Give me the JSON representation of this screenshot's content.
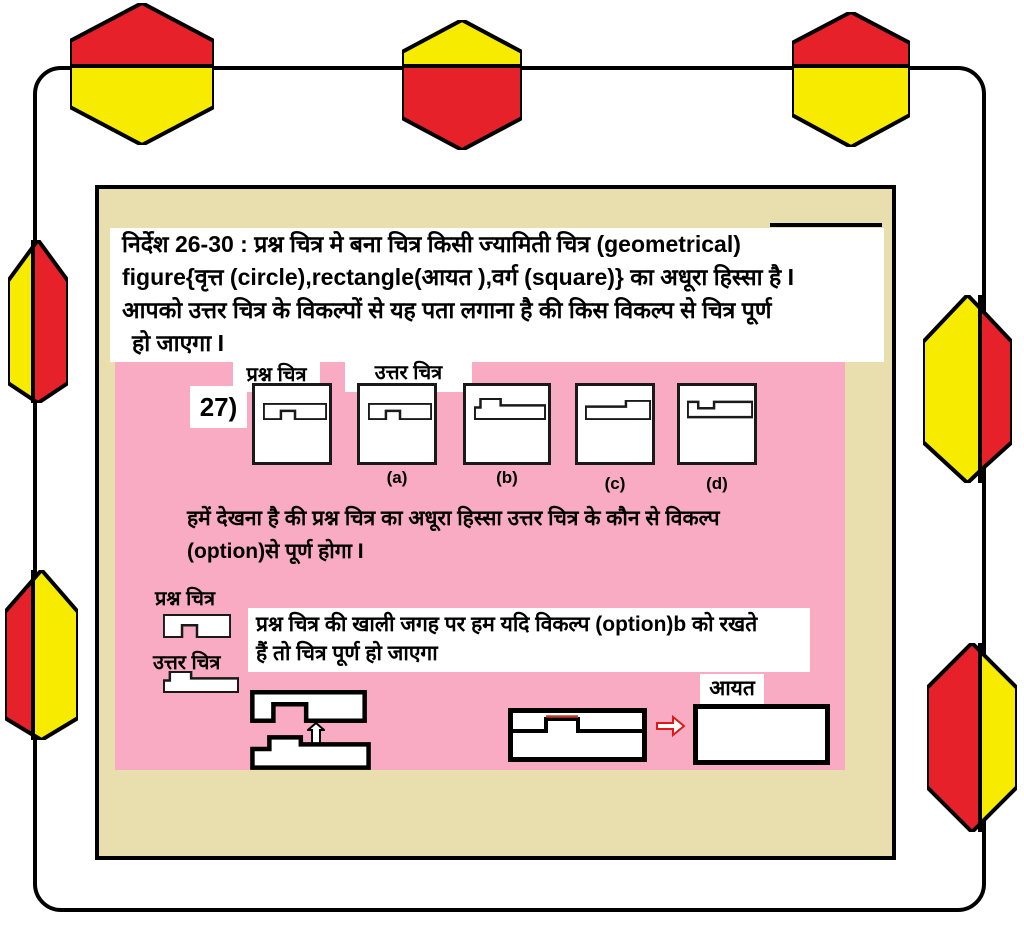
{
  "colors": {
    "page_background": "#ffffff",
    "panel_tan": "#e9dfae",
    "panel_pink": "#f8abc3",
    "decor_red": "#e62129",
    "decor_yellow": "#f7ec00",
    "border_black": "#000000",
    "seam_red": "#c0392b"
  },
  "instructions": {
    "line1": "निर्देश 26-30 : प्रश्न चित्र मे बना चित्र किसी ज्यामिती चित्र (geometrical)",
    "line2": "figure{वृत्त (circle),rectangle(आयत ),वर्ग (square)} का अधूरा हिस्सा है I",
    "line3": "आपको उत्तर चित्र के विकल्पों से यह पता लगाना है की किस विकल्प से चित्र पूर्ण",
    "line4": "हो जाएगा I"
  },
  "question": {
    "number_label": "27)",
    "question_figure_label": "प्रश्न चित्र",
    "answer_figure_label": "उत्तर  चित्र",
    "options": [
      {
        "label": "(a)"
      },
      {
        "label": "(b)"
      },
      {
        "label": "(c)"
      },
      {
        "label": "(d)"
      }
    ]
  },
  "explanation": {
    "observe_line1": "हमें देखना है की प्रश्न चित्र का अधूरा हिस्सा उत्तर चित्र के कौन से विकल्प",
    "observe_line2": "(option)से पूर्ण होगा I",
    "question_piece_label": "प्रश्न चित्र",
    "answer_piece_label": "उत्तर चित्र",
    "solution_line1": "प्रश्न चित्र की खाली जगह पर हम यदि विकल्प (option)b को रखते",
    "solution_line2": "हैं तो चित्र पूर्ण हो जाएगा",
    "result_shape_label": "आयत"
  }
}
